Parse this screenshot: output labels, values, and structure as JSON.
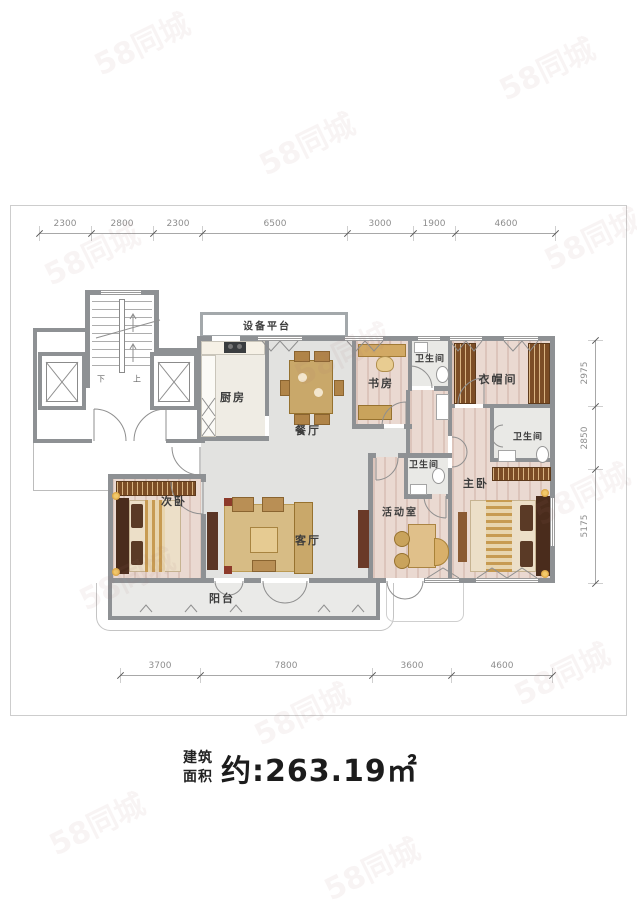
{
  "watermark": "58同城",
  "area": {
    "label_top": "建筑",
    "label_bottom": "面积",
    "value": "约:263.19㎡"
  },
  "rooms": {
    "equipment_platform": "设备平台",
    "kitchen": "厨房",
    "dining": "餐厅",
    "study": "书房",
    "bath_top": "卫生间",
    "closet": "衣帽间",
    "bath_right": "卫生间",
    "bath_mid": "卫生间",
    "second_bedroom": "次卧",
    "living": "客厅",
    "activity": "活动室",
    "master_bedroom": "主卧",
    "balcony": "阳台"
  },
  "stairs": {
    "down": "下",
    "up": "上"
  },
  "dimensions": {
    "top": [
      "2300",
      "2800",
      "2300",
      "6500",
      "3000",
      "1900",
      "4600"
    ],
    "bottom": [
      "3700",
      "7800",
      "3600",
      "4600"
    ],
    "right": [
      "2975",
      "2850",
      "5175"
    ]
  }
}
